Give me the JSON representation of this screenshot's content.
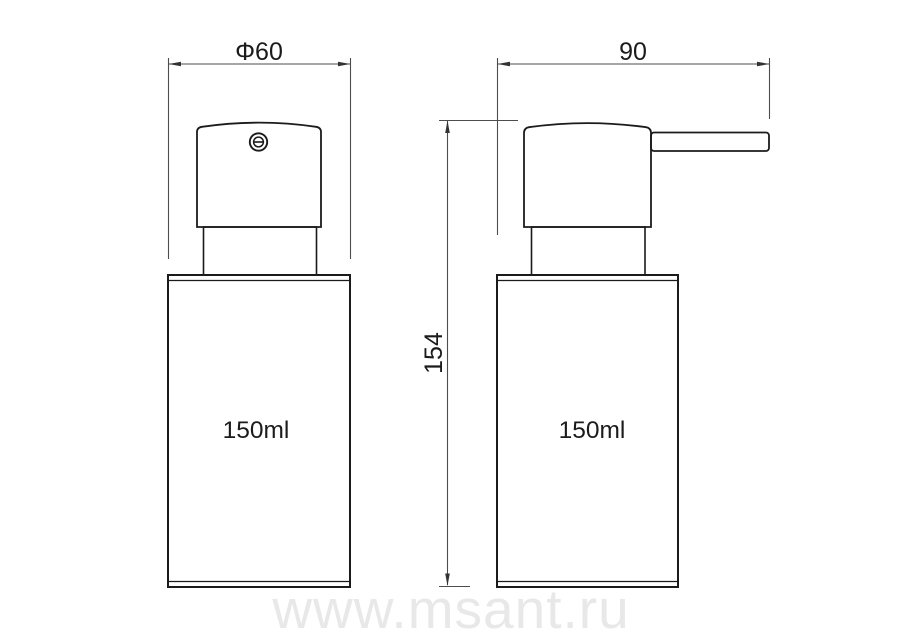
{
  "drawing": {
    "front_view": {
      "diameter_dim": "Φ60",
      "capacity_label": "150ml"
    },
    "side_view": {
      "width_dim": "90",
      "height_dim": "154",
      "capacity_label": "150ml"
    },
    "watermark": "www.msant.ru",
    "colors": {
      "line": "#1b1b1b",
      "dimension_line": "#4d4d4d",
      "watermark": "#e8e8e8",
      "background": "#ffffff"
    }
  }
}
